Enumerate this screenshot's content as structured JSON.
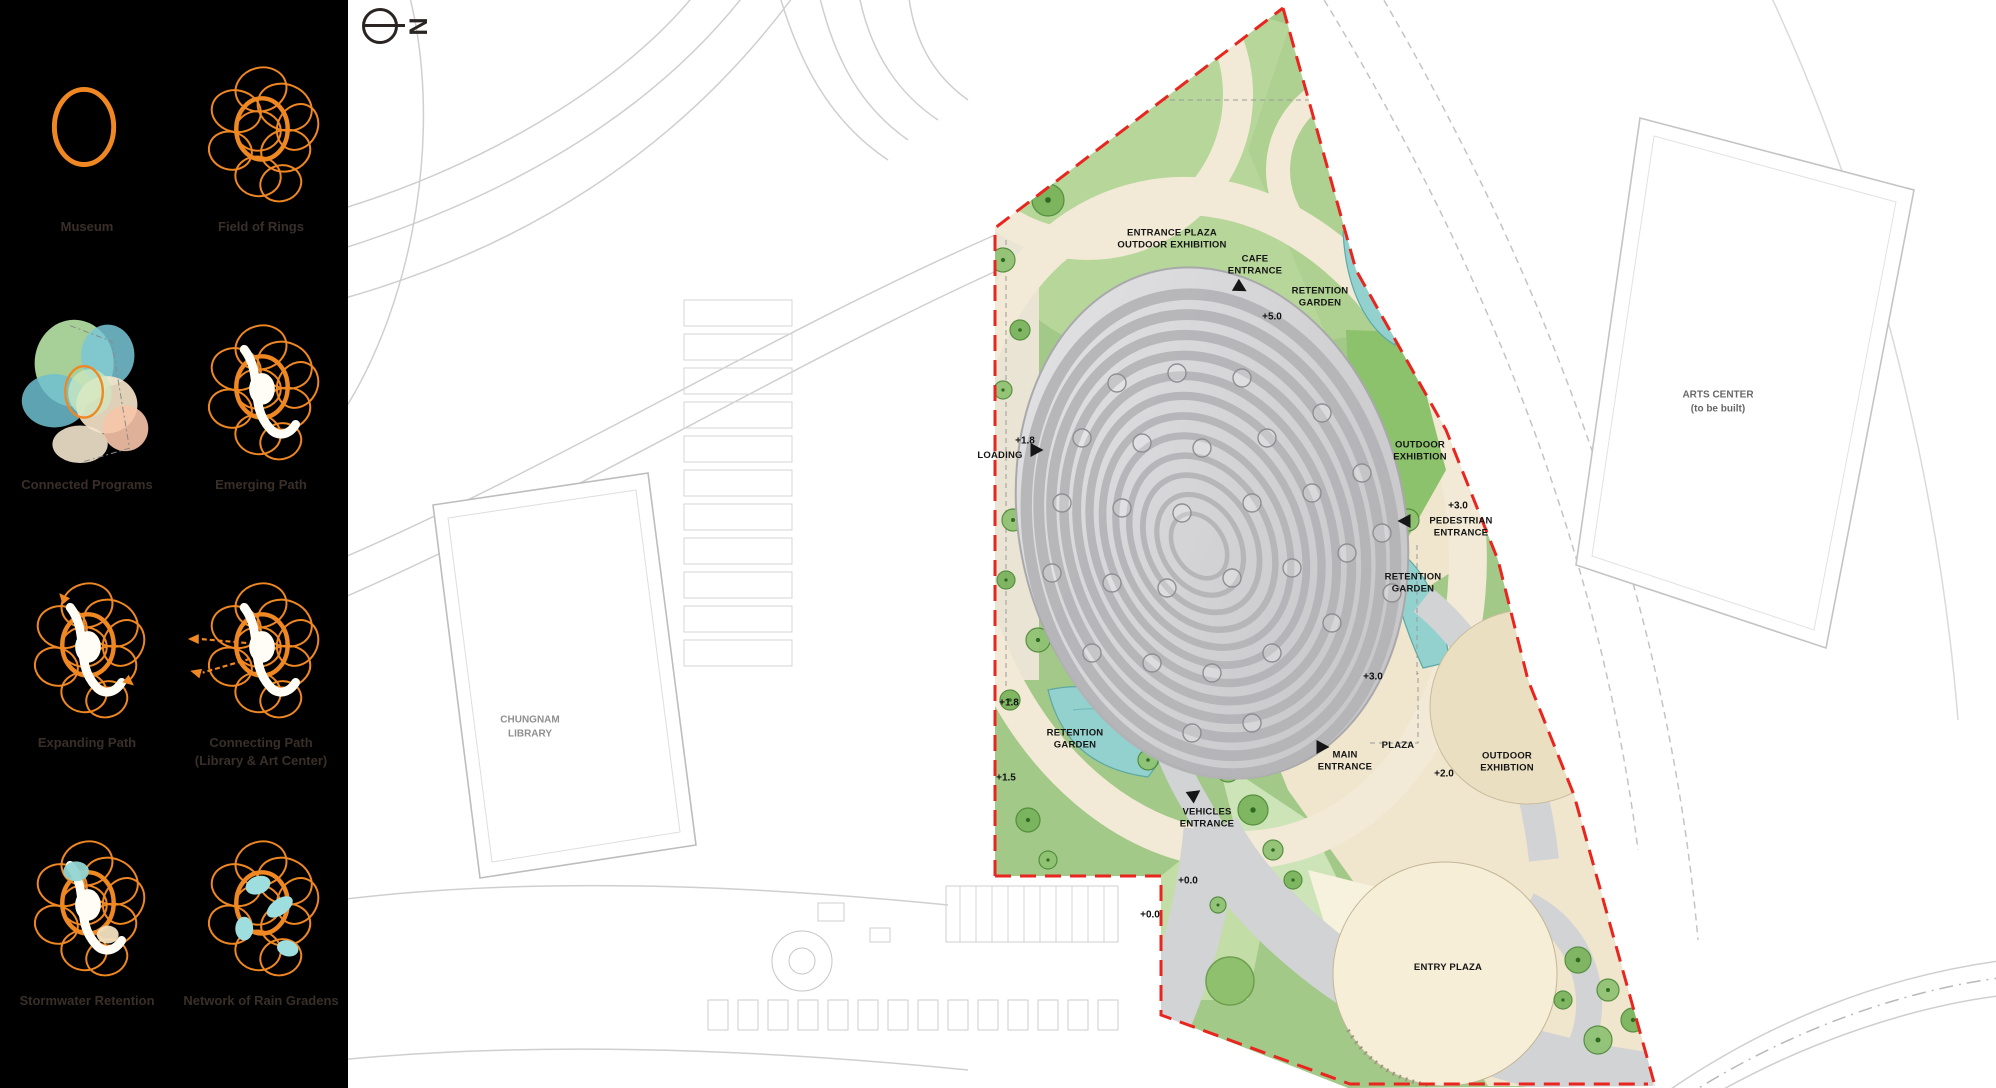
{
  "sidebar": {
    "accent_color": "#f08018",
    "diagrams": [
      {
        "label": "Museum"
      },
      {
        "label": "Field of Rings"
      },
      {
        "label": "Connected Programs"
      },
      {
        "label": "Emerging Path"
      },
      {
        "label": "Expanding Path"
      },
      {
        "label": "Connecting Path\n(Library & Art Center)"
      },
      {
        "label": "Stormwater Retention"
      },
      {
        "label": "Network of Rain Gradens"
      }
    ]
  },
  "plan": {
    "north": "N",
    "labels": {
      "entrance_plaza": "ENTRANCE PLAZA\nOUTDOOR EXHIBITION",
      "cafe_entrance": "CAFE\nENTRANCE",
      "retention_top": "RETENTION\nGARDEN",
      "outdoor_exh_east": "OUTDOOR\nEXHIBTION",
      "pedestrian": "PEDESTRIAN\nENTRANCE",
      "retention_east": "RETENTION\nGARDEN",
      "loading": "LOADING",
      "retention_west": "RETENTION\nGARDEN",
      "main_entrance": "MAIN\nENTRANCE",
      "plaza": "PLAZA",
      "outdoor_exh_south": "OUTDOOR\nEXHIBTION",
      "vehicles": "VEHICLES\nENTRANCE",
      "entry_plaza": "ENTRY PLAZA"
    },
    "elevations": {
      "cafe": "+5.0",
      "pedestrian": "+3.0",
      "east": "+3.0",
      "loading": "+1.8",
      "west_upper": "+1.8",
      "west_lower": "+1.5",
      "south": "+2.0",
      "vehicles_a": "+0.0",
      "vehicles_b": "+0.0"
    },
    "context": {
      "library": "CHUNGNAM\nLIBRARY",
      "arts_center": "ARTS CENTER\n(to be built)"
    },
    "colors": {
      "boundary_red": "#e8251f",
      "lawn_green": "#a2c988",
      "water_teal": "#93d1cf",
      "path_cream": "#f2ead6",
      "road_gray": "#d2d3d5",
      "building_gray": "#c9c9cc"
    }
  }
}
